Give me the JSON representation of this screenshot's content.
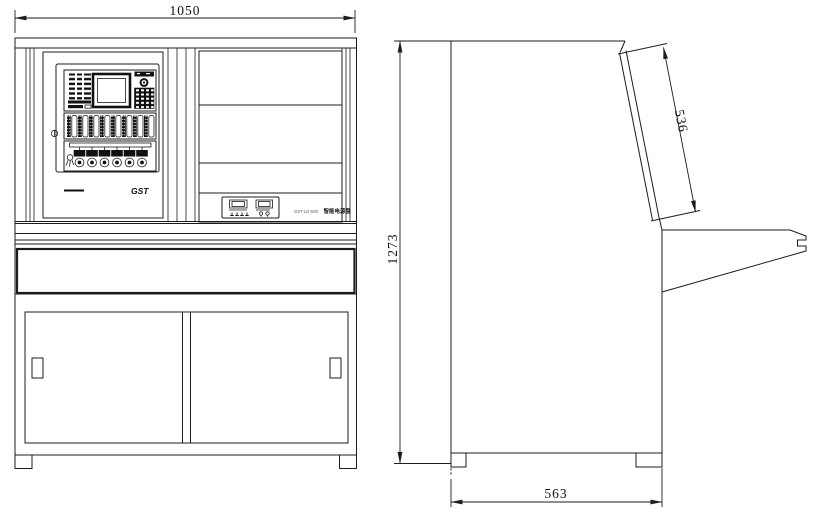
{
  "drawing": {
    "type": "engineering-orthographic-views",
    "subject": "fire-alarm control console cabinet (front view and side view)",
    "dimensions": {
      "front_width": "1050",
      "overall_height": "1273",
      "tilt_panel_length": "536",
      "base_depth": "563"
    },
    "labels": {
      "brand_logo": "GST",
      "power_panel_model": "GST-LD-D02",
      "power_panel_name": "智能电源盘"
    }
  }
}
